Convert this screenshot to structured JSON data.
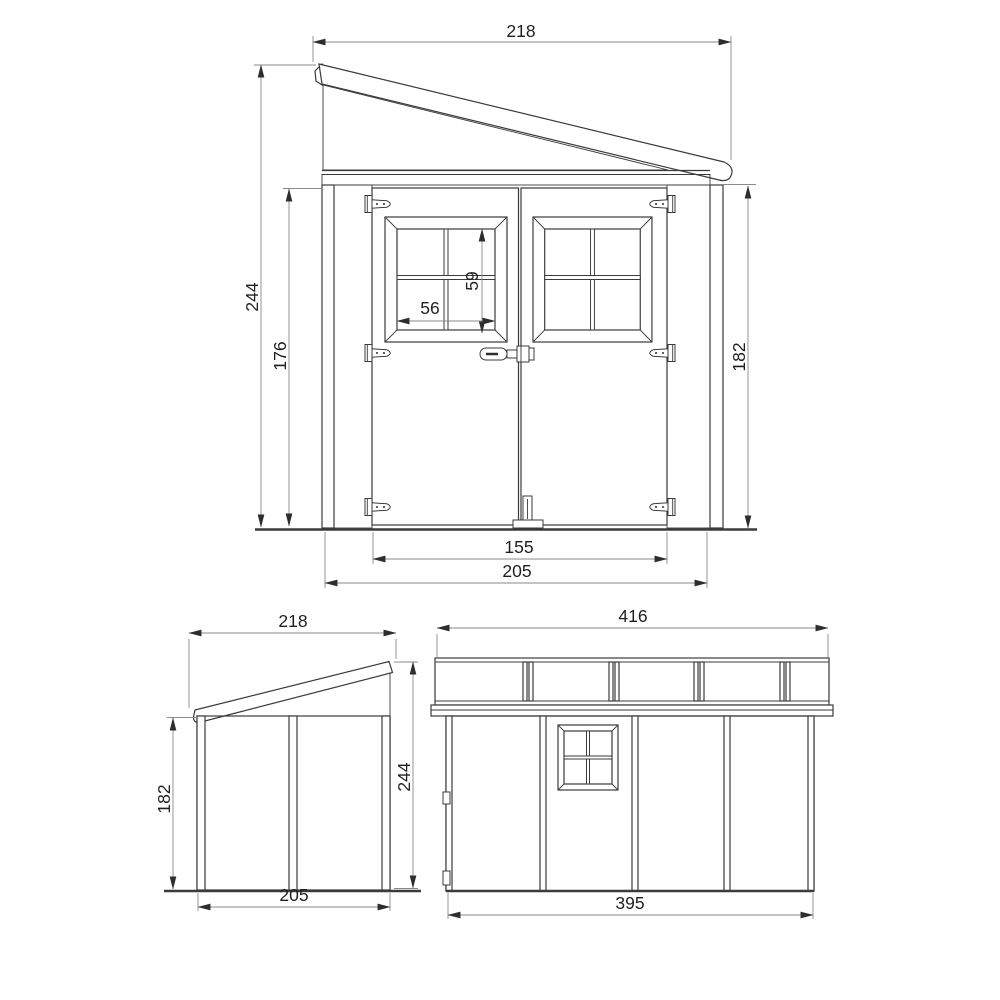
{
  "drawing": {
    "type": "technical-elevation-drawing",
    "subject": "garden-shed",
    "colors": {
      "background": "#ffffff",
      "object_line": "#3b3b3b",
      "dim_line": "#8a8a8a",
      "arrow": "#2e2e2e",
      "text": "#1f1f1f",
      "shade_light": "#c8c8c8",
      "shade_dark": "#b0b0b0"
    },
    "views": {
      "front": {
        "label": "front-elevation",
        "dims": {
          "roof_width": "218",
          "total_height": "244",
          "door_height": "176",
          "wall_height": "182",
          "window_height": "59",
          "window_width": "56",
          "door_opening_width": "155",
          "wall_width": "205"
        }
      },
      "side": {
        "label": "side-elevation",
        "dims": {
          "roof_depth": "218",
          "wall_height": "182",
          "total_height": "244",
          "wall_depth": "205"
        }
      },
      "long_side": {
        "label": "long-side-elevation",
        "dims": {
          "roof_length": "416",
          "wall_length": "395"
        }
      }
    }
  }
}
